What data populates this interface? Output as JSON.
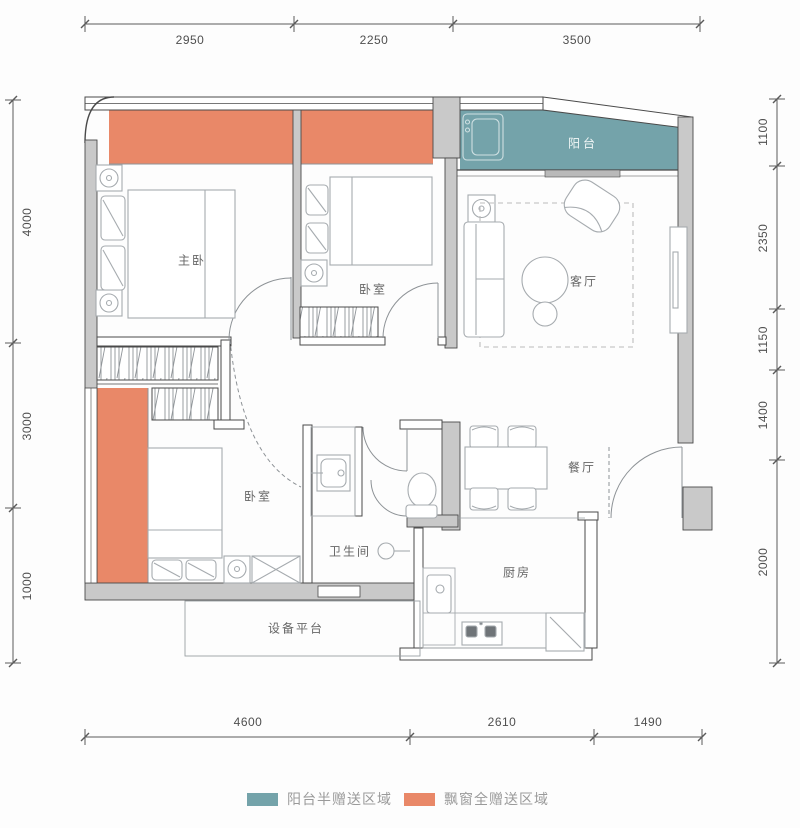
{
  "colors": {
    "bay_window_zone": "#E98868",
    "balcony_zone": "#74A3AA",
    "wall_fill": "#C9C9C9",
    "outline": "#4A4A4A",
    "furniture_line": "#A6ABAF",
    "room_text": "#666666",
    "dim_text": "#4F4F4F",
    "legend_text": "#9A9A9A"
  },
  "rooms": {
    "master_bedroom": "主卧",
    "bedroom_top": "卧室",
    "balcony": "阳台",
    "living_room": "客厅",
    "dining_room": "餐厅",
    "bedroom_bottom": "卧室",
    "bathroom": "卫生间",
    "kitchen": "厨房",
    "equipment_platform": "设备平台"
  },
  "dimensions": {
    "top": [
      "2950",
      "2250",
      "3500"
    ],
    "bottom": [
      "4600",
      "2610",
      "1490"
    ],
    "left": [
      "4000",
      "3000",
      "1000"
    ],
    "right": [
      "1100",
      "2350",
      "1150",
      "1400",
      "2000"
    ]
  },
  "legend": [
    {
      "label": "阳台半赠送区域",
      "color": "#74A3AA"
    },
    {
      "label": "飘窗全赠送区域",
      "color": "#E98868"
    }
  ]
}
